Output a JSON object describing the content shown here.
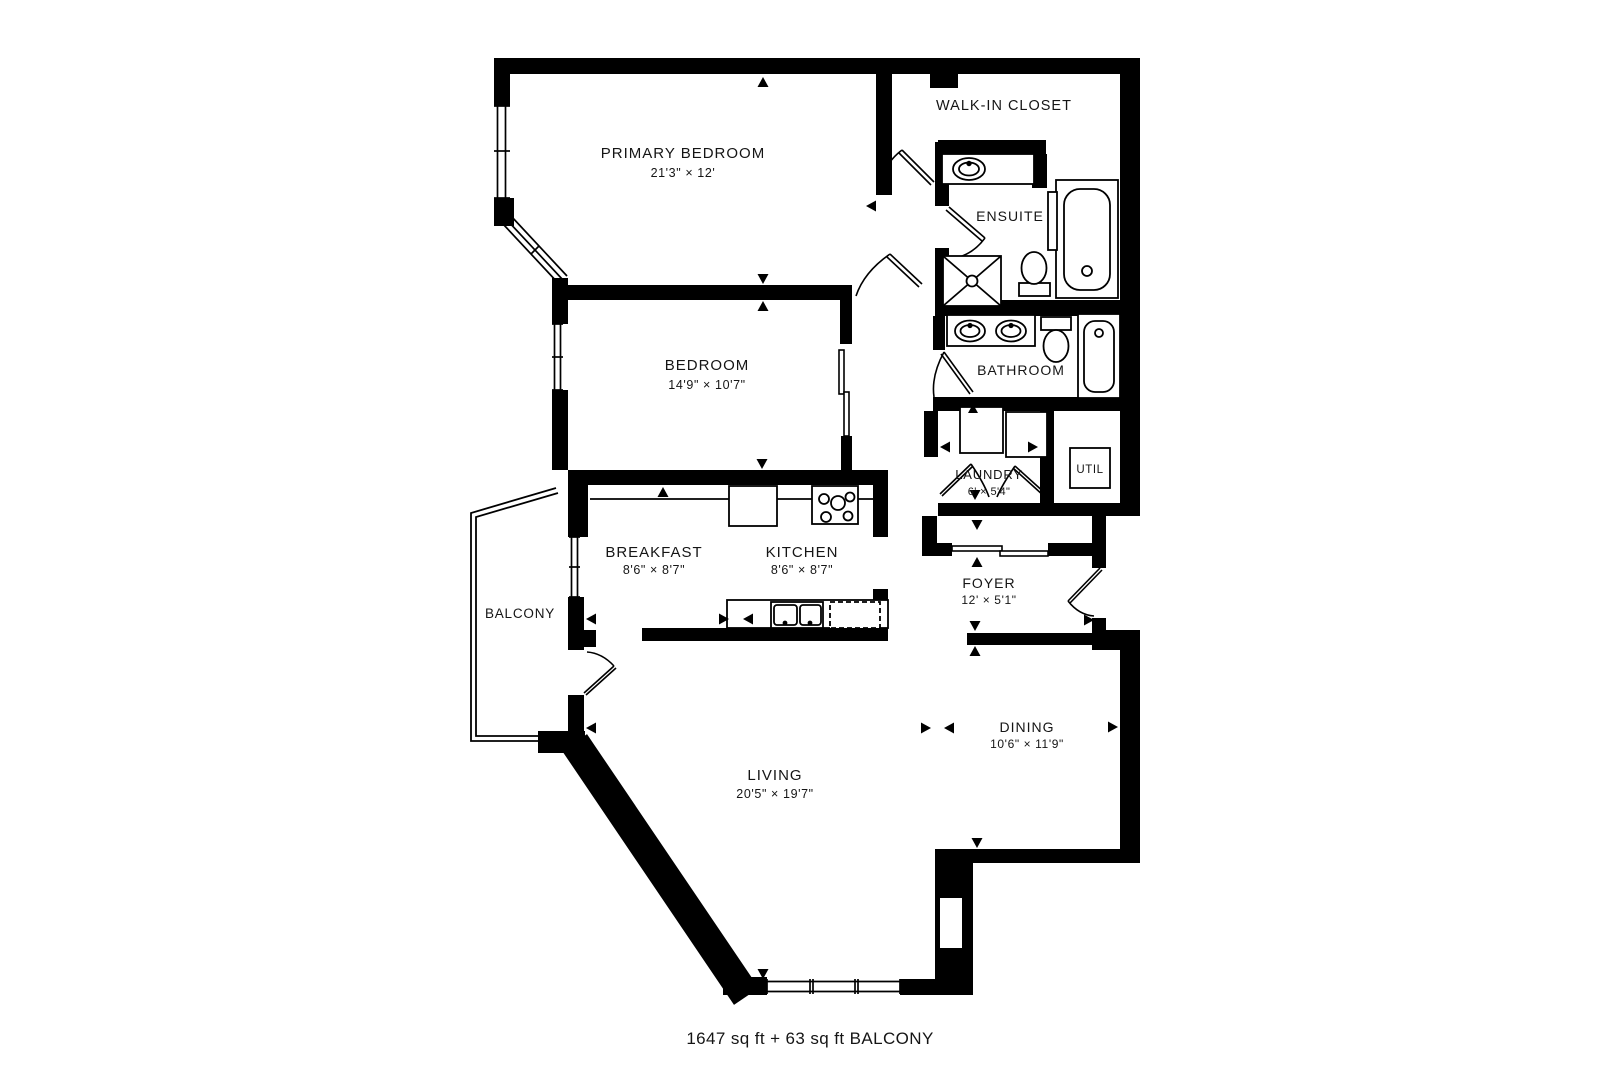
{
  "title": "Floor plan",
  "rooms": {
    "primary_bedroom": {
      "name": "PRIMARY BEDROOM",
      "dims": "21'3\" × 12'"
    },
    "walk_in_closet": {
      "name": "WALK-IN CLOSET"
    },
    "ensuite": {
      "name": "ENSUITE"
    },
    "bedroom": {
      "name": "BEDROOM",
      "dims": "14'9\" × 10'7\""
    },
    "bathroom": {
      "name": "BATHROOM"
    },
    "laundry": {
      "name": "LAUNDRY",
      "dims": "6' × 5'4\""
    },
    "util": {
      "name": "UTIL"
    },
    "breakfast": {
      "name": "BREAKFAST",
      "dims": "8'6\" × 8'7\""
    },
    "kitchen": {
      "name": "KITCHEN",
      "dims": "8'6\" × 8'7\""
    },
    "foyer": {
      "name": "FOYER",
      "dims": "12' × 5'1\""
    },
    "balcony": {
      "name": "BALCONY"
    },
    "living": {
      "name": "LIVING",
      "dims": "20'5\" × 19'7\""
    },
    "dining": {
      "name": "DINING",
      "dims": "10'6\" × 11'9\""
    }
  },
  "footer": {
    "area_text": "1647 sq ft + 63 sq ft BALCONY"
  },
  "colors": {
    "wall": "#000000",
    "background": "#ffffff",
    "text": "#151515"
  }
}
